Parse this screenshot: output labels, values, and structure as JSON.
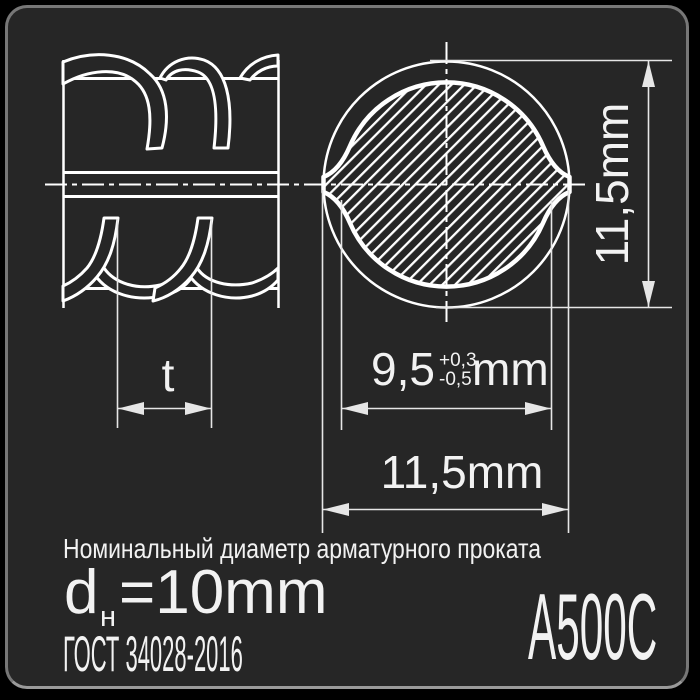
{
  "meta": {
    "background": "#000000",
    "card_background": "#262626",
    "drawing_color": "#ffffff",
    "dimension_color": "#e6e6e6",
    "border_color": "#8a8a8a"
  },
  "side_view": {
    "pitch_label": "t"
  },
  "cross_section": {
    "outer_diameter_right": "11,5mm",
    "outer_diameter_bottom": "11,5mm",
    "core_diameter_value": "9,5",
    "core_tolerance_plus": "+0,3",
    "core_tolerance_minus": "-0,5",
    "core_unit": "mm"
  },
  "footer": {
    "caption": "Номинальный диаметр арматурного проката",
    "diameter_symbol": "d",
    "diameter_subscript": "н",
    "diameter_value": "=10mm",
    "standard": "ГОСТ 34028-2016",
    "grade": "А500С"
  }
}
